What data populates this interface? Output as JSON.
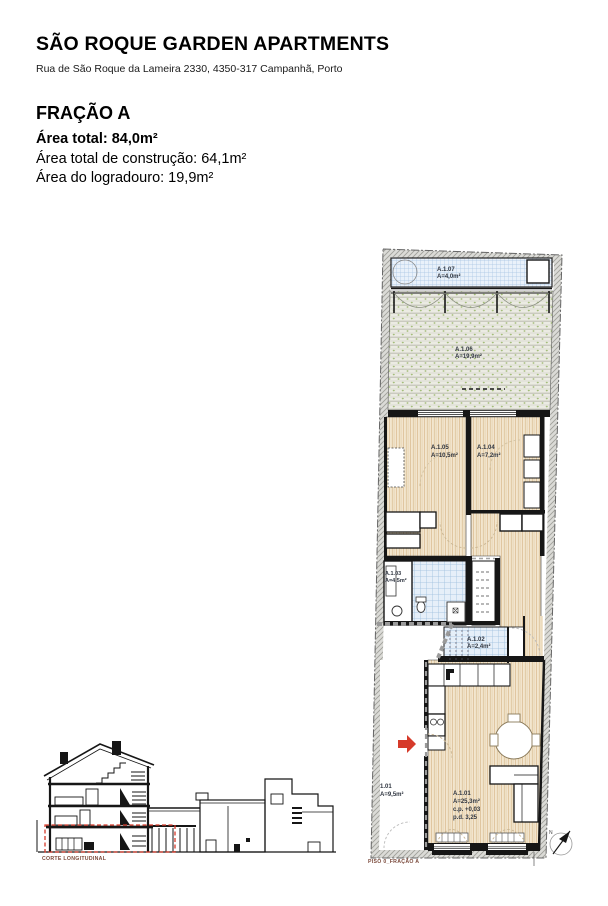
{
  "header": {
    "title": "SÃO ROQUE GARDEN APARTMENTS",
    "address": "Rua de São Roque da Lameira 2330, 4350-317 Campanhã, Porto"
  },
  "fraction": {
    "name": "FRAÇÃO A",
    "rows": [
      {
        "label": "Área total:",
        "value": "84,0m²"
      },
      {
        "label": "Área total de construção:",
        "value": "64,1m²"
      },
      {
        "label": "Área do logradouro:",
        "value": "19,9m²"
      }
    ]
  },
  "plan": {
    "caption": "PISO 0_FRAÇÃO A",
    "north_letter": "N",
    "rooms": {
      "a107": {
        "id": "A.1.07",
        "area": "A=4,0m²"
      },
      "a106": {
        "id": "A.1.06",
        "area": "A=19,9m²"
      },
      "a105": {
        "id": "A.1.05",
        "area": "A=10,5m²"
      },
      "a104": {
        "id": "A.1.04",
        "area": "A=7,2m²"
      },
      "a103": {
        "id": "A.1.03",
        "area": "A=4,5m²"
      },
      "a102": {
        "id": "A.1.02",
        "area": "A=2,4m²"
      },
      "a101": {
        "id": "A.1.01",
        "area": "A=25,3m²",
        "cp": "c.p. +0,03",
        "pd": "p.d. 3,25"
      },
      "r101": {
        "id": "1.01",
        "area": "A=9,5m²"
      }
    }
  },
  "section": {
    "caption": "CORTE LONGITUDINAL"
  },
  "icons": {
    "north": "compass-needle",
    "entrance": "red-arrow-right"
  },
  "colors": {
    "accent_red": "#d63a2a",
    "tile_blue_bg": "#e6eff9",
    "tile_blue_line": "#9dbede",
    "garden_green": "#9cb86e",
    "wood_line": "#d8ba8e",
    "wall_black": "#161616",
    "hatch_gray": "#a0a09a",
    "caption_brown": "#7b4a3c"
  }
}
